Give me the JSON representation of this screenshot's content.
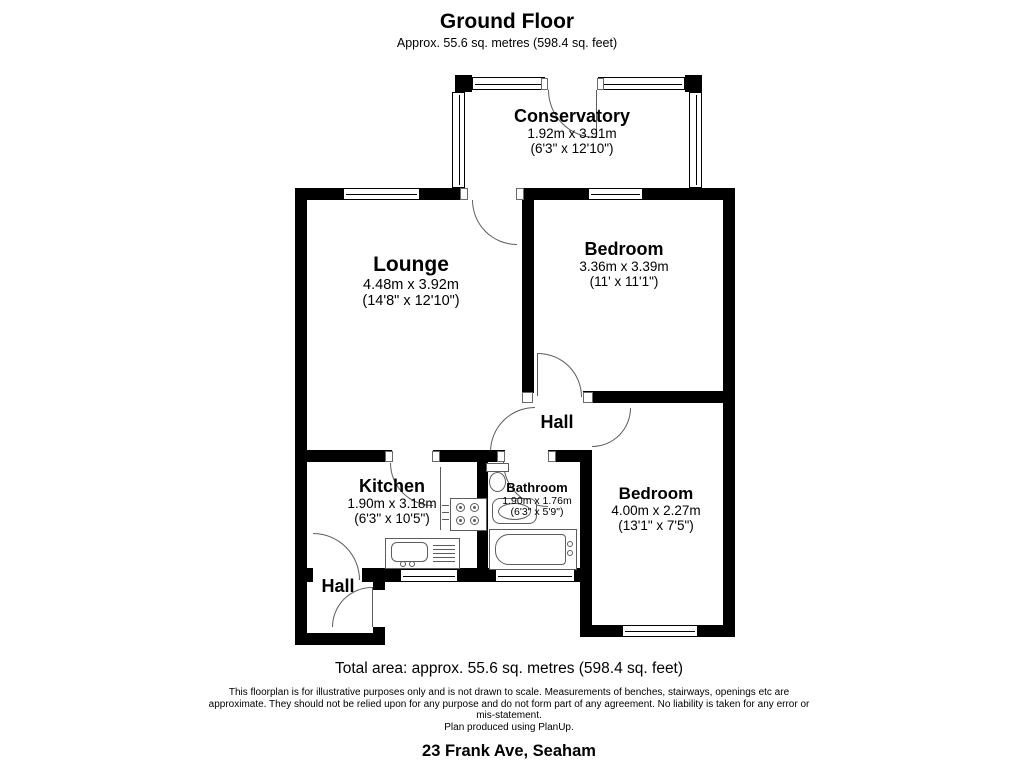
{
  "header": {
    "title": "Ground Floor",
    "subtitle": "Approx. 55.6 sq. metres (598.4 sq. feet)"
  },
  "rooms": {
    "conservatory": {
      "name": "Conservatory",
      "metric": "1.92m x 3.91m",
      "imperial": "(6'3\" x 12'10\")"
    },
    "lounge": {
      "name": "Lounge",
      "metric": "4.48m x 3.92m",
      "imperial": "(14'8\" x 12'10\")"
    },
    "bedroom1": {
      "name": "Bedroom",
      "metric": "3.36m x 3.39m",
      "imperial": "(11' x 11'1\")"
    },
    "hall": {
      "name": "Hall"
    },
    "kitchen": {
      "name": "Kitchen",
      "metric": "1.90m x 3.18m",
      "imperial": "(6'3\" x 10'5\")"
    },
    "bathroom": {
      "name": "Bathroom",
      "metric": "1.90m x 1.76m",
      "imperial": "(6'3\" x 5'9\")"
    },
    "bedroom2": {
      "name": "Bedroom",
      "metric": "4.00m x 2.27m",
      "imperial": "(13'1\" x 7'5\")"
    },
    "hall2": {
      "name": "Hall"
    }
  },
  "footer": {
    "total_area": "Total area: approx. 55.6 sq. metres (598.4 sq. feet)",
    "disclaimer": [
      "This floorplan is for illustrative purposes only and is not drawn to scale. Measurements of benches, stairways, openings etc are",
      "approximate. They should not be relied upon for any purpose and do not form part of any agreement. No liability is taken for any error or",
      "mis-statement.",
      "Plan produced using PlanUp."
    ],
    "address": "23 Frank Ave, Seaham"
  },
  "colors": {
    "wall": "#000000",
    "fixture_line": "#5c5c5c",
    "text": "#000000",
    "background": "#ffffff"
  }
}
